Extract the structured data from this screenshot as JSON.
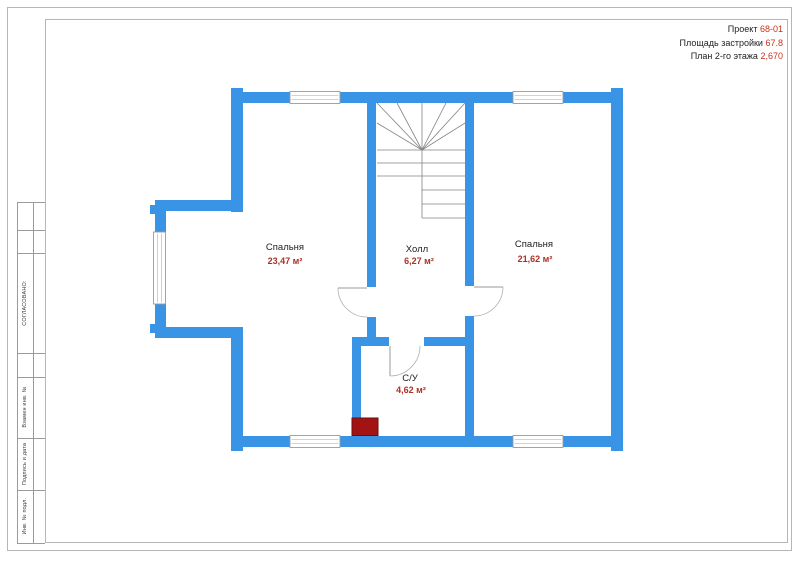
{
  "header": {
    "project_label": "Проект",
    "project_value": "68-01",
    "area_label": "Площадь застройки",
    "area_value": "67.8",
    "plan_label": "План 2-го этажа",
    "plan_value": "2,670"
  },
  "title_block": {
    "approved": "СОГЛАСОВАНО:",
    "fields": [
      "Взамен инв. №",
      "Подпись и дата",
      "Инв. № подл."
    ]
  },
  "rooms": [
    {
      "name": "Спальня",
      "area": "23,47 м²"
    },
    {
      "name": "Холл",
      "area": "6,27 м²"
    },
    {
      "name": "Спальня",
      "area": "21,62 м²"
    },
    {
      "name": "С/У",
      "area": "4,62 м²"
    }
  ],
  "colors": {
    "wall_blue": "#3a94e6",
    "header_value_red": "#c9301c",
    "room_area_red": "#a93226",
    "flue_red": "#a21414"
  }
}
